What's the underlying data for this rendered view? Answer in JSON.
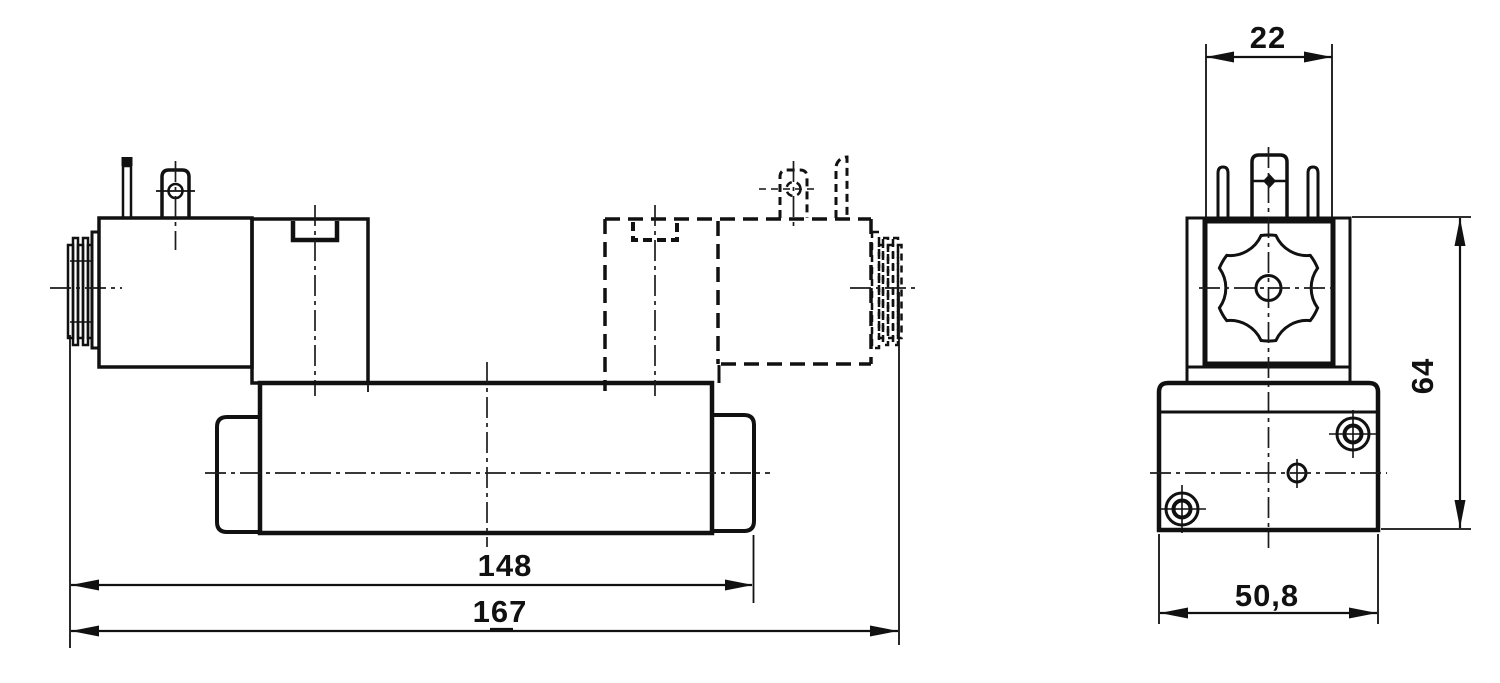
{
  "drawing": {
    "colors": {
      "ink": "#111111",
      "background": "#ffffff"
    },
    "dimensions": {
      "body_length": {
        "value": "148"
      },
      "overall_length": {
        "value": "167",
        "not_to_scale_underline": true
      },
      "coil_width": {
        "value": "22"
      },
      "overall_height": {
        "value": "64"
      },
      "body_width": {
        "value": "50,8"
      }
    }
  }
}
